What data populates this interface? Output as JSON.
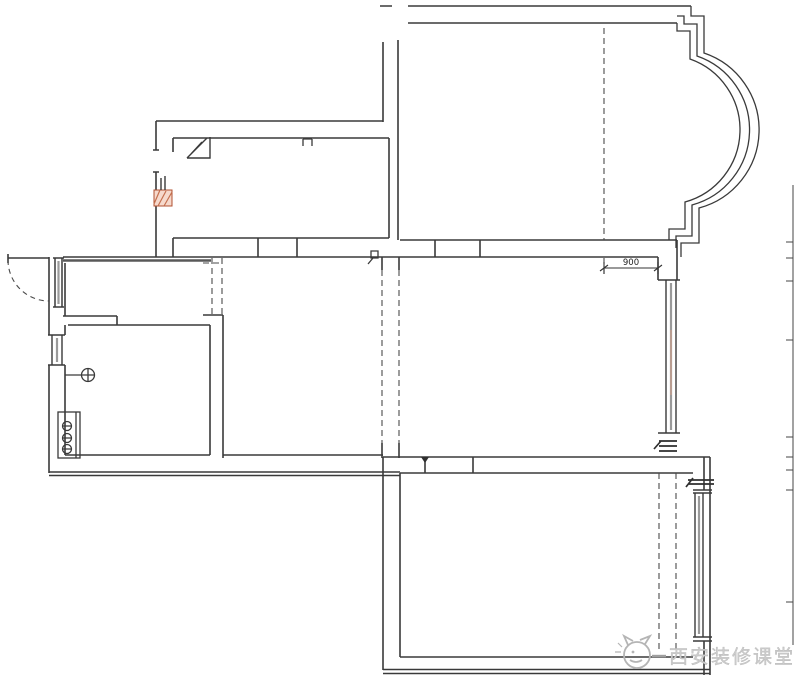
{
  "drawing": {
    "type": "residential floor plan (CAD line drawing)",
    "dimension": {
      "value": "900"
    },
    "watermark": {
      "text": "西安装修课堂"
    },
    "colors": {
      "background": "#ffffff",
      "line": "#3a3a3a",
      "window_core": "#9a9a9a",
      "highlight_orange": "#c4704f",
      "watermark_gray": "#cdcdcd"
    },
    "icons": {
      "entry-door-swing-icon": "quarter-arc dashed",
      "bay-window-icon": "triple concentric arc",
      "window-icon": "double parallel line with end caps",
      "radiator-icon": "rect with three circled dashes",
      "floor-drain-icon": "circle with crosshair",
      "flue-icon": "corner square with diagonal",
      "wall-break-icon": "short stacked horizontal lines",
      "watermark-logo-icon": "cat outline in circle"
    }
  }
}
